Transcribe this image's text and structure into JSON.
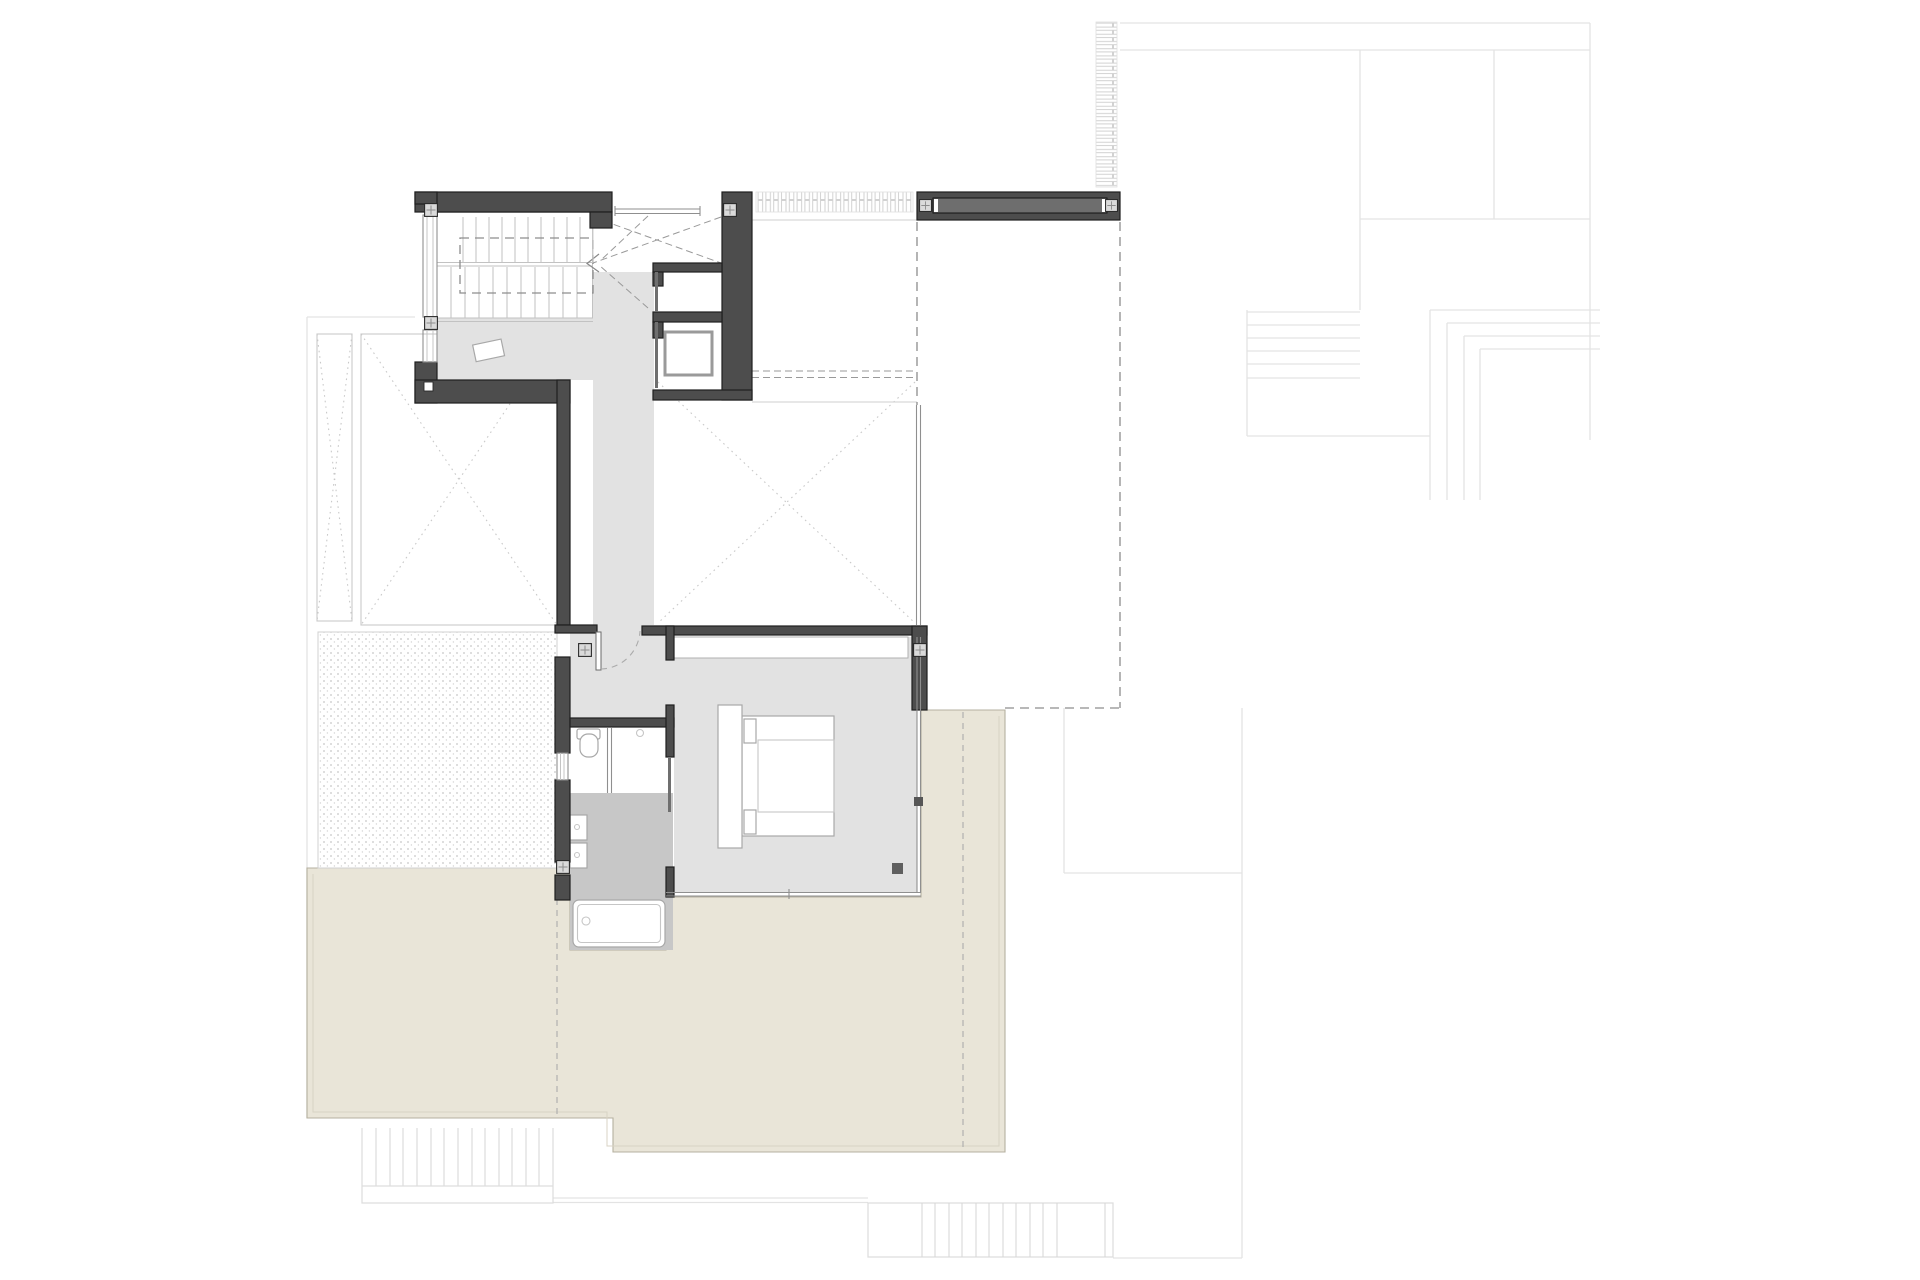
{
  "drawing": {
    "type": "architectural floor plan",
    "description": "upper floor plan with U-stair, corridor, bedroom with bed, bathroom with tub, stippled gravel court, beige roof terrace, louver strips and faint lower-level outlines",
    "visible_text": []
  },
  "colors": {
    "wall": "#4d4d4d",
    "wall_outline": "#1f1f1f",
    "floor": "#e2e2e2",
    "floor_wet": "#c7c7c7",
    "terrace": "#e9e5d8",
    "terrace_outline": "#b5b0a0",
    "beam_slot": "#6e6e6e",
    "column_fill": "#dadada",
    "faint_line": "#e3e3e3",
    "hatch_line": "#d2d2d2",
    "dash_line": "#8d8d8d",
    "dot_line": "#c9c9c9",
    "fixture_line": "#a8a8a8",
    "stipple_dot": "#c6c6c6",
    "tread_line": "#c2c2c2"
  },
  "features": {
    "stair_flight_count": 2,
    "column_markers": 8,
    "exterior_stairs": 3
  }
}
